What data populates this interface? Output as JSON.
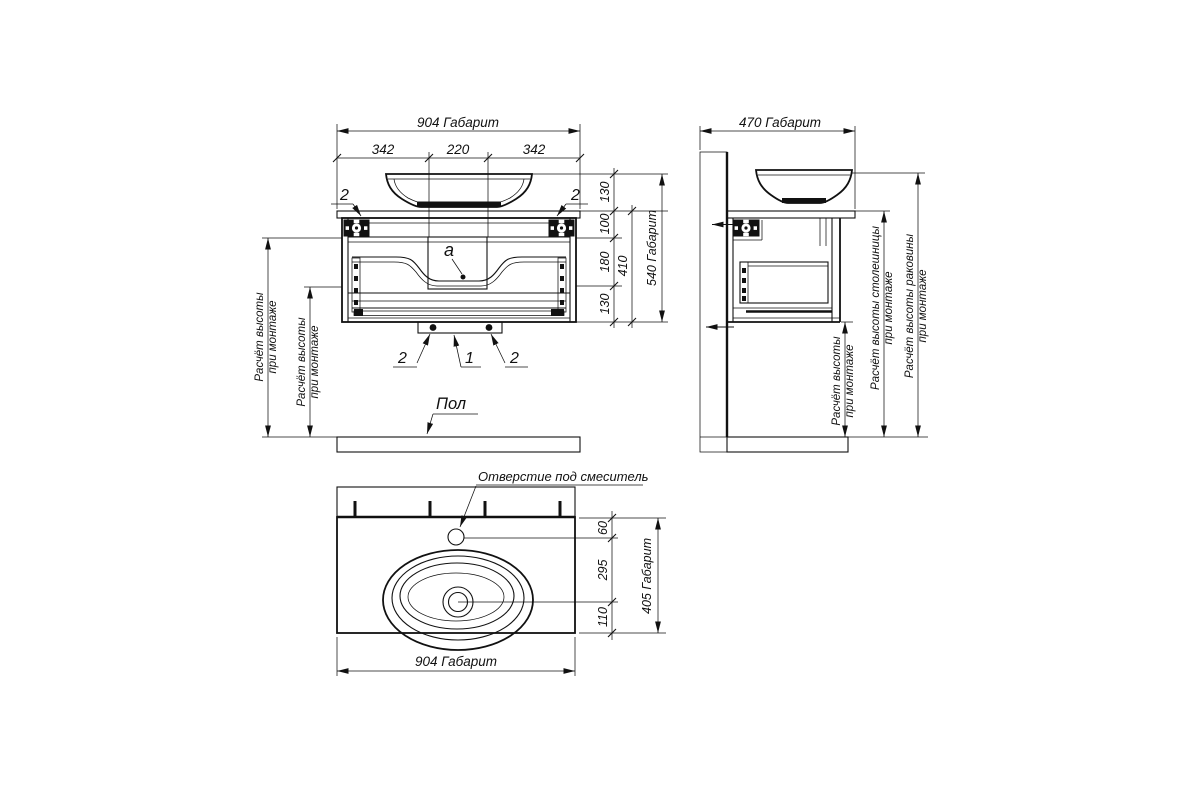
{
  "front": {
    "dim_width_overall": "904 Габарит",
    "seg_dims": [
      "342",
      "220",
      "342"
    ],
    "right_segs": [
      "130",
      "100",
      "180",
      "130"
    ],
    "dim_cabinet_height": "410",
    "dim_height_overall": "540 Габарит",
    "mount_height_l1": "Расчёт высоты",
    "mount_height_l2": "при монтаже",
    "callouts": {
      "bracket_left": "2",
      "bracket_right": "2",
      "foot_left": "2",
      "siphon": "1",
      "foot_right": "2"
    },
    "detail_a": "a",
    "floor": "Пол"
  },
  "side": {
    "dim_depth_overall": "470 Габарит",
    "h1_l1": "Расчёт высоты",
    "h1_l2": "при монтаже",
    "h2_l1": "Расчёт высоты столешницы",
    "h2_l2": "при монтаже",
    "h3_l1": "Расчёт высоты раковины",
    "h3_l2": "при монтаже"
  },
  "plan": {
    "faucet_label": "Отверстие под смеситель",
    "depth_segs": [
      "60",
      "295",
      "110"
    ],
    "dim_depth_overall": "405 Габарит",
    "dim_width_overall": "904 Габарит"
  },
  "colors": {
    "line": "#111111",
    "background": "#ffffff"
  }
}
